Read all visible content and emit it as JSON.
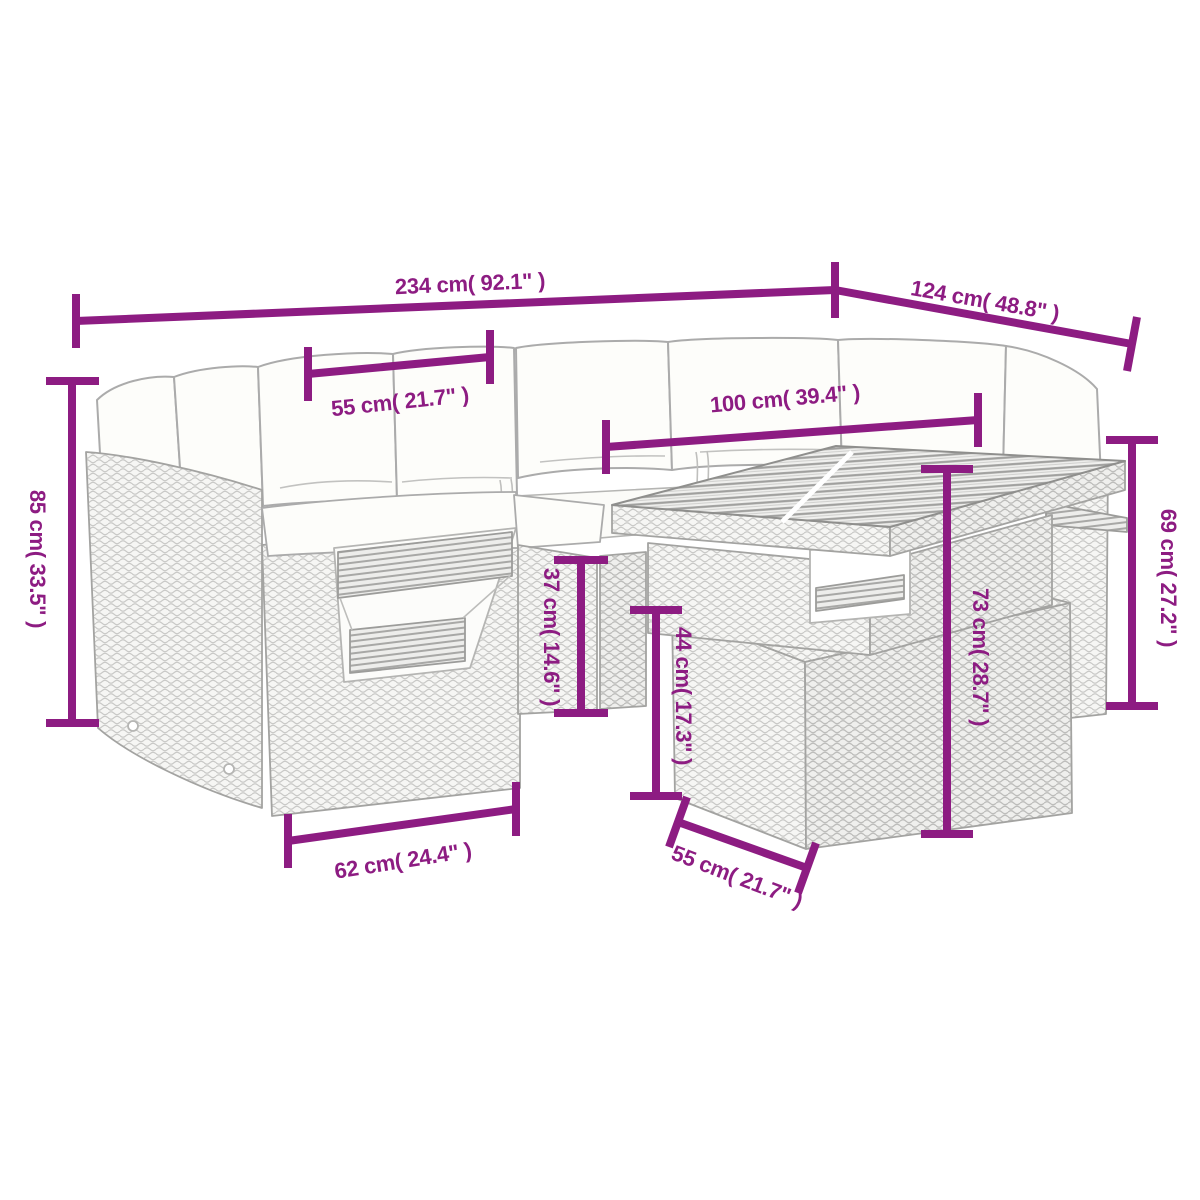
{
  "figure": {
    "kind": "product-dimension-diagram",
    "subject": "poly rattan garden lounge set: corner sofa with cushions, fold-out tray, middle seat and height-adjustable table",
    "colors": {
      "background": "#ffffff",
      "dimension_accent": "#8d1c82",
      "line_art_outline": "#a3a3a1",
      "rattan_weave": "#c9c9c7",
      "cushion_fill": "#fdfdfa",
      "slat_dark": "#a0a09e"
    }
  },
  "dimensions": {
    "labels": {
      "total_width": "234 cm( 92.1\" )",
      "total_depth": "124 cm( 48.8\" )",
      "back_height": "85 cm( 33.5\" )",
      "seat_width": "55 cm( 21.7\" )",
      "table_width": "100 cm( 39.4\" )",
      "tray_height": "37 cm( 14.6\" )",
      "base_height": "44 cm( 17.3\" )",
      "table_height": "73 cm( 28.7\" )",
      "tabletop_side_height": "69 cm( 27.2\" )",
      "seat_depth": "62 cm( 24.4\" )",
      "table_depth": "55 cm( 21.7\" )"
    }
  }
}
